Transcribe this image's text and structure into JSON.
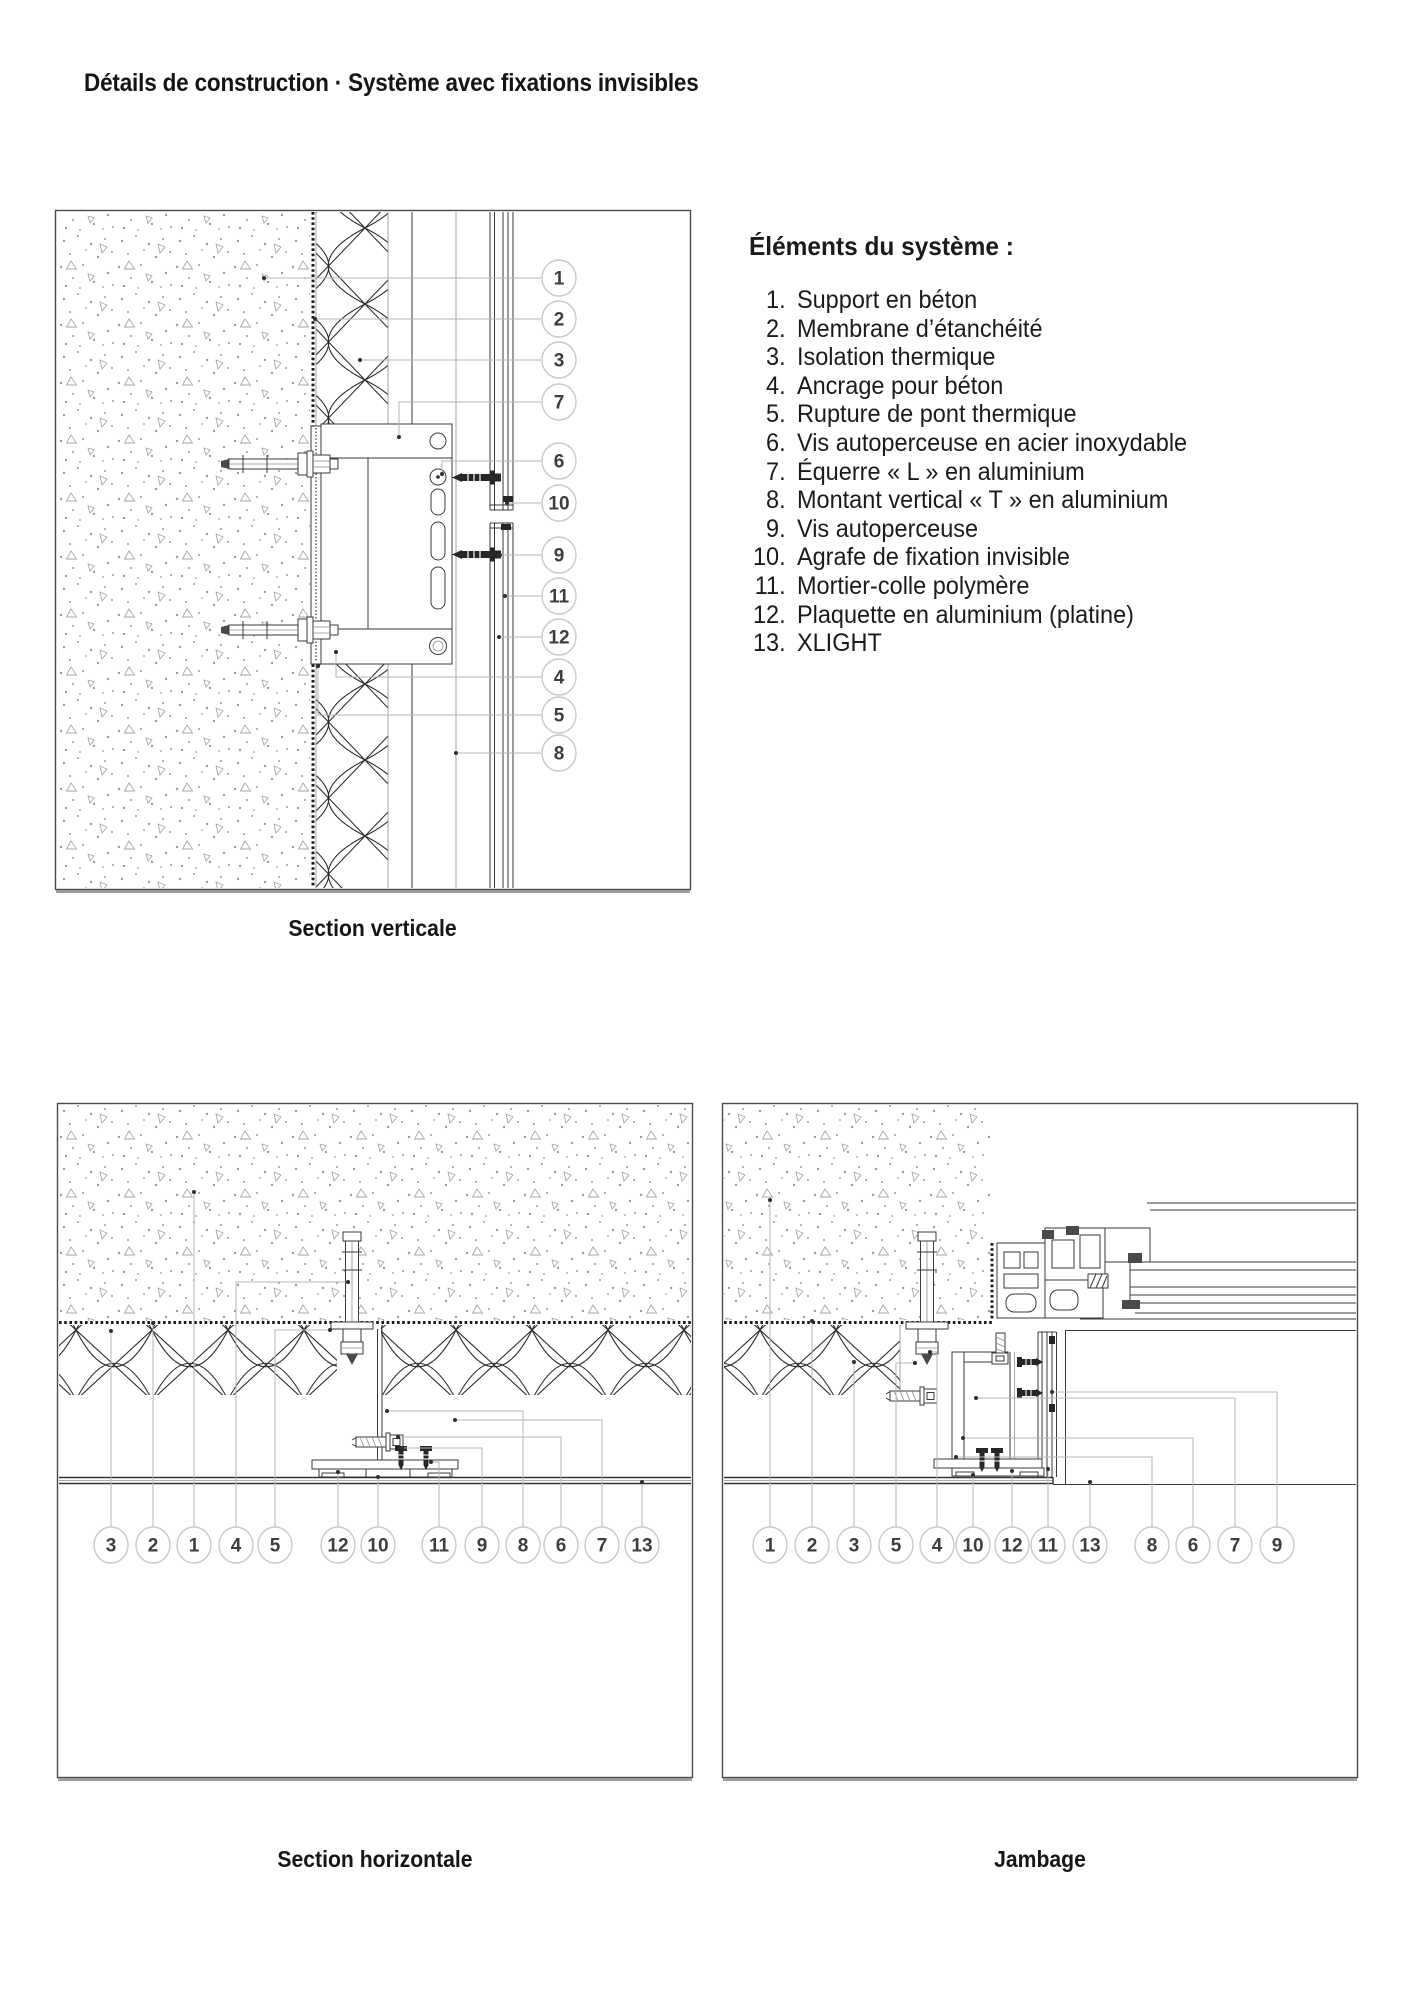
{
  "page": {
    "title": "Détails de construction · Système avec fixations invisibles"
  },
  "legend": {
    "heading": "Éléments du système :",
    "items": [
      {
        "num": "1.",
        "label": "Support en béton"
      },
      {
        "num": "2.",
        "label": "Membrane d’étanchéité"
      },
      {
        "num": "3.",
        "label": "Isolation thermique"
      },
      {
        "num": "4.",
        "label": "Ancrage pour béton"
      },
      {
        "num": "5.",
        "label": "Rupture de pont thermique"
      },
      {
        "num": "6.",
        "label": "Vis autoperceuse en acier inoxydable"
      },
      {
        "num": "7.",
        "label": "Équerre « L » en aluminium"
      },
      {
        "num": "8.",
        "label": "Montant vertical « T » en aluminium"
      },
      {
        "num": "9.",
        "label": "Vis autoperceuse"
      },
      {
        "num": "10.",
        "label": "Agrafe de fixation invisible"
      },
      {
        "num": "11.",
        "label": "Mortier-colle polymère"
      },
      {
        "num": "12.",
        "label": "Plaquette en aluminium (platine)"
      },
      {
        "num": "13.",
        "label": "XLIGHT"
      }
    ]
  },
  "sections": {
    "vertical": {
      "caption": "Section verticale"
    },
    "horizontal": {
      "caption": "Section horizontale"
    },
    "jamb": {
      "caption": "Jambage"
    }
  },
  "style": {
    "line_color": "#3a3a3a",
    "leader_color": "#b5b5b5",
    "callout_ring": "#c9c9c9",
    "callout_text": "#3e3e3e",
    "membrane_color": "#1c1c1c"
  },
  "callouts": {
    "vertical": [
      {
        "n": "1",
        "cx": 559,
        "cy": 278,
        "leader": [
          [
            541,
            278
          ],
          [
            264,
            278
          ]
        ]
      },
      {
        "n": "2",
        "cx": 559,
        "cy": 319,
        "leader": [
          [
            541,
            319
          ],
          [
            315,
            319
          ]
        ]
      },
      {
        "n": "3",
        "cx": 559,
        "cy": 360,
        "leader": [
          [
            541,
            360
          ],
          [
            360,
            360
          ]
        ]
      },
      {
        "n": "7",
        "cx": 559,
        "cy": 402,
        "leader": [
          [
            541,
            402
          ],
          [
            399,
            402
          ],
          [
            399,
            437
          ]
        ]
      },
      {
        "n": "6",
        "cx": 559,
        "cy": 461,
        "leader": [
          [
            541,
            461
          ],
          [
            442,
            461
          ],
          [
            442,
            474
          ]
        ]
      },
      {
        "n": "10",
        "cx": 559,
        "cy": 503,
        "leader": [
          [
            541,
            503
          ],
          [
            507,
            503
          ]
        ]
      },
      {
        "n": "9",
        "cx": 559,
        "cy": 555,
        "leader": [
          [
            541,
            555
          ],
          [
            500,
            555
          ]
        ]
      },
      {
        "n": "11",
        "cx": 559,
        "cy": 596,
        "leader": [
          [
            541,
            596
          ],
          [
            505,
            596
          ]
        ]
      },
      {
        "n": "12",
        "cx": 559,
        "cy": 637,
        "leader": [
          [
            541,
            637
          ],
          [
            499,
            637
          ]
        ]
      },
      {
        "n": "4",
        "cx": 559,
        "cy": 677,
        "leader": [
          [
            541,
            677
          ],
          [
            336,
            677
          ],
          [
            336,
            652
          ]
        ]
      },
      {
        "n": "5",
        "cx": 559,
        "cy": 715,
        "leader": [
          [
            541,
            715
          ],
          [
            318,
            715
          ],
          [
            318,
            666
          ]
        ]
      },
      {
        "n": "8",
        "cx": 559,
        "cy": 753,
        "leader": [
          [
            541,
            753
          ],
          [
            456,
            753
          ]
        ]
      }
    ],
    "horizontal": [
      {
        "n": "3",
        "cx": 111,
        "cy": 1545,
        "leader": [
          [
            111,
            1527
          ],
          [
            111,
            1331
          ]
        ]
      },
      {
        "n": "2",
        "cx": 153,
        "cy": 1545,
        "leader": [
          [
            153,
            1527
          ],
          [
            153,
            1323
          ]
        ]
      },
      {
        "n": "1",
        "cx": 194,
        "cy": 1545,
        "leader": [
          [
            194,
            1527
          ],
          [
            194,
            1192
          ]
        ]
      },
      {
        "n": "4",
        "cx": 236,
        "cy": 1545,
        "leader": [
          [
            236,
            1527
          ],
          [
            236,
            1282
          ],
          [
            348,
            1282
          ]
        ]
      },
      {
        "n": "5",
        "cx": 275,
        "cy": 1545,
        "leader": [
          [
            275,
            1527
          ],
          [
            275,
            1330
          ],
          [
            330,
            1330
          ]
        ]
      },
      {
        "n": "12",
        "cx": 338,
        "cy": 1545,
        "leader": [
          [
            338,
            1527
          ],
          [
            338,
            1472
          ]
        ]
      },
      {
        "n": "10",
        "cx": 378,
        "cy": 1545,
        "leader": [
          [
            378,
            1527
          ],
          [
            378,
            1477
          ]
        ]
      },
      {
        "n": "11",
        "cx": 439,
        "cy": 1545,
        "leader": [
          [
            439,
            1527
          ],
          [
            439,
            1462
          ],
          [
            431,
            1462
          ]
        ]
      },
      {
        "n": "9",
        "cx": 482,
        "cy": 1545,
        "leader": [
          [
            482,
            1527
          ],
          [
            482,
            1448
          ],
          [
            402,
            1448
          ]
        ]
      },
      {
        "n": "8",
        "cx": 523,
        "cy": 1545,
        "leader": [
          [
            523,
            1527
          ],
          [
            523,
            1411
          ],
          [
            387,
            1411
          ]
        ]
      },
      {
        "n": "6",
        "cx": 561,
        "cy": 1545,
        "leader": [
          [
            561,
            1527
          ],
          [
            561,
            1437
          ],
          [
            398,
            1437
          ]
        ]
      },
      {
        "n": "7",
        "cx": 602,
        "cy": 1545,
        "leader": [
          [
            602,
            1527
          ],
          [
            602,
            1420
          ],
          [
            455,
            1420
          ]
        ]
      },
      {
        "n": "13",
        "cx": 642,
        "cy": 1545,
        "leader": [
          [
            642,
            1527
          ],
          [
            642,
            1482
          ]
        ]
      }
    ],
    "jamb": [
      {
        "n": "1",
        "cx": 770,
        "cy": 1545,
        "leader": [
          [
            770,
            1527
          ],
          [
            770,
            1200
          ]
        ]
      },
      {
        "n": "2",
        "cx": 812,
        "cy": 1545,
        "leader": [
          [
            812,
            1527
          ],
          [
            812,
            1321
          ]
        ]
      },
      {
        "n": "3",
        "cx": 854,
        "cy": 1545,
        "leader": [
          [
            854,
            1527
          ],
          [
            854,
            1362
          ]
        ]
      },
      {
        "n": "5",
        "cx": 896,
        "cy": 1545,
        "leader": [
          [
            896,
            1527
          ],
          [
            896,
            1363
          ],
          [
            915,
            1363
          ]
        ]
      },
      {
        "n": "4",
        "cx": 937,
        "cy": 1545,
        "leader": [
          [
            937,
            1527
          ],
          [
            937,
            1352
          ],
          [
            930,
            1352
          ]
        ]
      },
      {
        "n": "10",
        "cx": 973,
        "cy": 1545,
        "leader": [
          [
            973,
            1527
          ],
          [
            973,
            1475
          ]
        ]
      },
      {
        "n": "12",
        "cx": 1012,
        "cy": 1545,
        "leader": [
          [
            1012,
            1527
          ],
          [
            1012,
            1471
          ]
        ]
      },
      {
        "n": "11",
        "cx": 1048,
        "cy": 1545,
        "leader": [
          [
            1048,
            1527
          ],
          [
            1048,
            1469
          ]
        ]
      },
      {
        "n": "13",
        "cx": 1090,
        "cy": 1545,
        "leader": [
          [
            1090,
            1527
          ],
          [
            1090,
            1482
          ]
        ]
      },
      {
        "n": "8",
        "cx": 1152,
        "cy": 1545,
        "leader": [
          [
            1152,
            1527
          ],
          [
            1152,
            1457
          ],
          [
            956,
            1457
          ]
        ]
      },
      {
        "n": "6",
        "cx": 1193,
        "cy": 1545,
        "leader": [
          [
            1193,
            1527
          ],
          [
            1193,
            1438
          ],
          [
            963,
            1438
          ]
        ]
      },
      {
        "n": "7",
        "cx": 1235,
        "cy": 1545,
        "leader": [
          [
            1235,
            1527
          ],
          [
            1235,
            1398
          ],
          [
            976,
            1398
          ]
        ]
      },
      {
        "n": "9",
        "cx": 1277,
        "cy": 1545,
        "leader": [
          [
            1277,
            1527
          ],
          [
            1277,
            1392
          ],
          [
            1052,
            1392
          ]
        ]
      }
    ]
  }
}
